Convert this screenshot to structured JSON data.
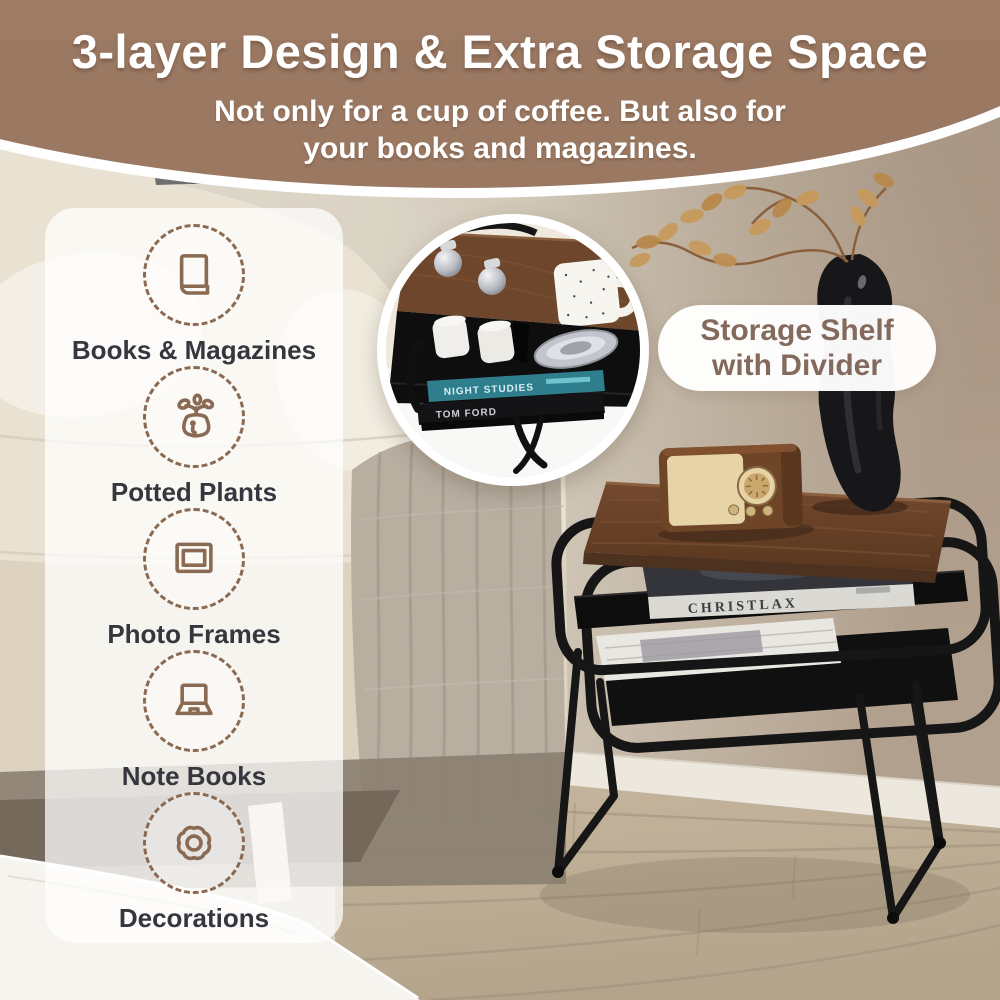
{
  "header": {
    "title": "3-layer Design & Extra Storage Space",
    "subtitle_line1": "Not only for a cup of coffee. But also for",
    "subtitle_line2": "your books and magazines.",
    "bg_color": "#9a7862",
    "text_color": "#ffffff"
  },
  "sidebar": {
    "panel_color": "rgba(255,255,255,0.74)",
    "icon_color": "#8a6a52",
    "label_color": "#35363e",
    "items": [
      {
        "icon": "book-icon",
        "label": "Books & Magazines"
      },
      {
        "icon": "potted-plant-icon",
        "label": "Potted Plants"
      },
      {
        "icon": "photo-frame-icon",
        "label": "Photo Frames"
      },
      {
        "icon": "laptop-icon",
        "label": "Note Books"
      },
      {
        "icon": "flower-icon",
        "label": "Decorations"
      }
    ]
  },
  "callout": {
    "line1": "Storage Shelf",
    "line2": "with Divider",
    "text_color": "#836a5c",
    "bg_color": "#ffffff"
  },
  "photo": {
    "shelf_book_spine": "CHRISTLAX",
    "inset_book_spine_top": "NIGHT STUDIES",
    "inset_book_spine_bottom": "TOM FORD",
    "wood_color": "#6e462c",
    "frame_color": "#151515",
    "teal_book_color": "#2f7e8d"
  }
}
